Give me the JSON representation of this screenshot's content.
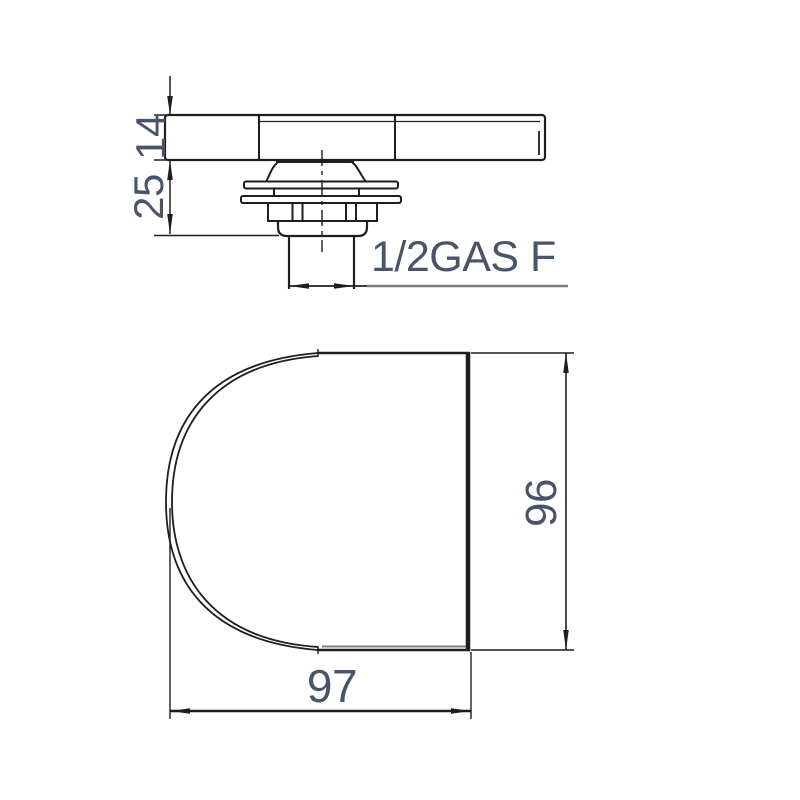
{
  "drawing": {
    "type": "technical-dimension-drawing",
    "views": {
      "side_view": {
        "thickness_dim": "14",
        "stem_height_dim": "25",
        "thread_label": "1/2GAS F"
      },
      "plan_view": {
        "width_dim": "97",
        "height_dim": "96"
      }
    },
    "colors": {
      "line": "#1e1e1e",
      "gray_line": "#7f7f7f",
      "dim_text": "#4a5468",
      "background": "#ffffff"
    }
  }
}
